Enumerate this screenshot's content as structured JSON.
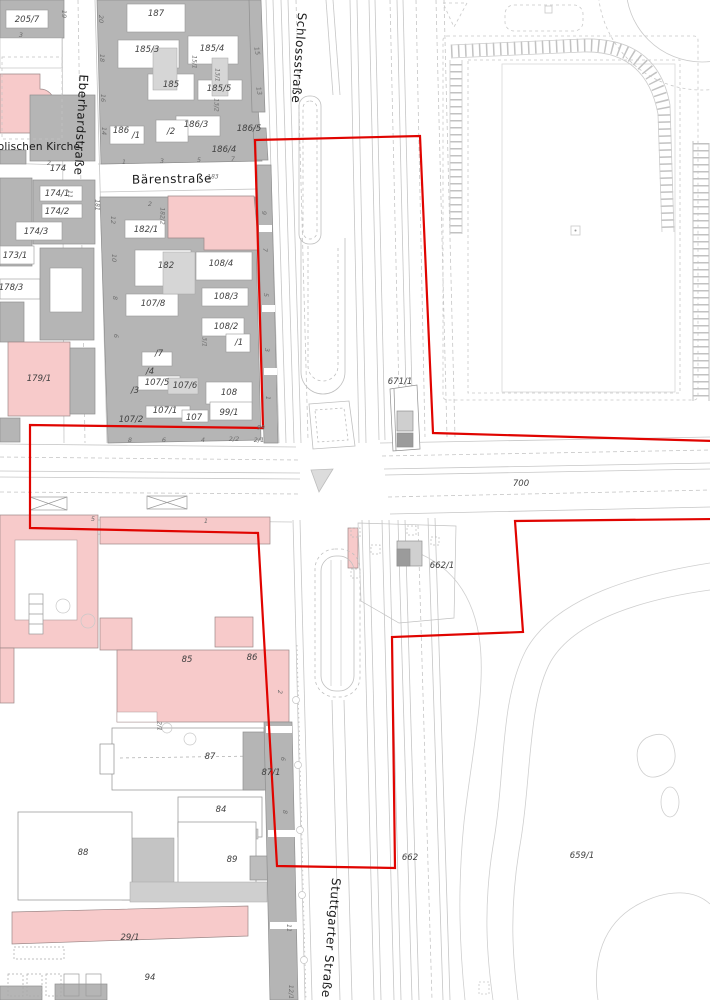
{
  "map": {
    "type": "cadastral-city-map",
    "colors": {
      "boundary_red": "#e00400",
      "building_gray": "#b5b5b5",
      "building_light": "#d6d6d6",
      "building_pink": "#f7caca",
      "road_line": "#c6c6c6"
    }
  },
  "map_labels": [
    {
      "name": "street-schlossstrasse",
      "text": "Schlossstraße",
      "x": 299,
      "y": 58,
      "rot": 94,
      "cls": "street"
    },
    {
      "name": "street-eberhardstrasse",
      "text": "Eberhardstraße",
      "x": 81,
      "y": 125,
      "rot": 93,
      "cls": "street"
    },
    {
      "name": "street-baerenstrasse",
      "text": "Bärenstraße",
      "x": 172,
      "y": 179,
      "rot": -1,
      "cls": "street"
    },
    {
      "name": "street-stuttgarter-strasse",
      "text": "Stuttgarter Straße",
      "x": 331,
      "y": 938,
      "rot": 95,
      "cls": "street"
    },
    {
      "name": "street-kirche-partial",
      "text": "olischen Kirche",
      "x": 39,
      "y": 147,
      "rot": 0,
      "cls": "street small"
    },
    {
      "name": "parcel-205-7",
      "text": "205/7",
      "x": 27,
      "y": 20,
      "cls": "parcel"
    },
    {
      "name": "parcel-187",
      "text": "187",
      "x": 156,
      "y": 14,
      "cls": "parcel"
    },
    {
      "name": "parcel-185-3",
      "text": "185/3",
      "x": 147,
      "y": 50,
      "cls": "parcel"
    },
    {
      "name": "parcel-185-4",
      "text": "185/4",
      "x": 212,
      "y": 49,
      "cls": "parcel"
    },
    {
      "name": "parcel-185",
      "text": "185",
      "x": 171,
      "y": 85,
      "cls": "parcel"
    },
    {
      "name": "parcel-185-5",
      "text": "185/5",
      "x": 219,
      "y": 89,
      "cls": "parcel"
    },
    {
      "name": "parcel-186-3",
      "text": "186/3",
      "x": 196,
      "y": 125,
      "cls": "parcel"
    },
    {
      "name": "parcel-186-5",
      "text": "186/5",
      "x": 249,
      "y": 129,
      "cls": "parcel"
    },
    {
      "name": "parcel-186-4",
      "text": "186/4",
      "x": 224,
      "y": 150,
      "cls": "parcel"
    },
    {
      "name": "parcel-186",
      "text": "186",
      "x": 121,
      "y": 131,
      "cls": "parcel"
    },
    {
      "name": "parcel-186-1",
      "text": "/1",
      "x": 136,
      "y": 136,
      "cls": "parcel"
    },
    {
      "name": "parcel-186-2",
      "text": "/2",
      "x": 171,
      "y": 132,
      "cls": "parcel"
    },
    {
      "name": "parcel-183",
      "text": "183",
      "x": 213,
      "y": 177,
      "cls": "tiny"
    },
    {
      "name": "parcel-181",
      "text": "181",
      "x": 97,
      "y": 205,
      "rot": 90,
      "cls": "tiny"
    },
    {
      "name": "parcel-15-1",
      "text": "15/1",
      "x": 194,
      "y": 62,
      "rot": 90,
      "cls": "tiny"
    },
    {
      "name": "parcel-13-1",
      "text": "13/1",
      "x": 217,
      "y": 75,
      "rot": 90,
      "cls": "tiny"
    },
    {
      "name": "parcel-13-2",
      "text": "13/2",
      "x": 216,
      "y": 105,
      "rot": 90,
      "cls": "tiny"
    },
    {
      "name": "parcel-174",
      "text": "174",
      "x": 58,
      "y": 169,
      "cls": "parcel"
    },
    {
      "name": "parcel-174-1",
      "text": "174/1",
      "x": 57,
      "y": 194,
      "cls": "parcel"
    },
    {
      "name": "parcel-174-2",
      "text": "174/2",
      "x": 57,
      "y": 212,
      "cls": "parcel"
    },
    {
      "name": "parcel-174-3",
      "text": "174/3",
      "x": 36,
      "y": 232,
      "cls": "parcel"
    },
    {
      "name": "parcel-173-1",
      "text": "173/1",
      "x": 15,
      "y": 256,
      "cls": "parcel"
    },
    {
      "name": "parcel-178-3",
      "text": "178/3",
      "x": 11,
      "y": 288,
      "cls": "parcel"
    },
    {
      "name": "parcel-179-1",
      "text": "179/1",
      "x": 39,
      "y": 379,
      "cls": "parcel"
    },
    {
      "name": "parcel-182-1",
      "text": "182/1",
      "x": 146,
      "y": 230,
      "cls": "parcel"
    },
    {
      "name": "parcel-182-2",
      "text": "182/2",
      "x": 162,
      "y": 216,
      "rot": 90,
      "cls": "tiny"
    },
    {
      "name": "parcel-182",
      "text": "182",
      "x": 166,
      "y": 266,
      "cls": "parcel"
    },
    {
      "name": "parcel-108-4",
      "text": "108/4",
      "x": 221,
      "y": 264,
      "cls": "parcel"
    },
    {
      "name": "parcel-108-3",
      "text": "108/3",
      "x": 226,
      "y": 297,
      "cls": "parcel"
    },
    {
      "name": "parcel-107-8",
      "text": "107/8",
      "x": 153,
      "y": 304,
      "cls": "parcel"
    },
    {
      "name": "parcel-108-2",
      "text": "108/2",
      "x": 226,
      "y": 327,
      "cls": "parcel"
    },
    {
      "name": "parcel-108-2-1",
      "text": "/1",
      "x": 239,
      "y": 343,
      "cls": "parcel"
    },
    {
      "name": "parcel-3-1",
      "text": "3/1",
      "x": 204,
      "y": 342,
      "rot": 90,
      "cls": "tiny"
    },
    {
      "name": "parcel-107-7",
      "text": "/7",
      "x": 159,
      "y": 354,
      "cls": "parcel"
    },
    {
      "name": "parcel-107-4",
      "text": "/4",
      "x": 150,
      "y": 372,
      "cls": "parcel"
    },
    {
      "name": "parcel-107-5",
      "text": "107/5",
      "x": 157,
      "y": 383,
      "cls": "parcel"
    },
    {
      "name": "parcel-107-6",
      "text": "107/6",
      "x": 185,
      "y": 386,
      "cls": "parcel"
    },
    {
      "name": "parcel-108",
      "text": "108",
      "x": 229,
      "y": 393,
      "cls": "parcel"
    },
    {
      "name": "parcel-107-3",
      "text": "/3",
      "x": 135,
      "y": 391,
      "cls": "parcel"
    },
    {
      "name": "parcel-107-2",
      "text": "107/2",
      "x": 131,
      "y": 420,
      "cls": "parcel"
    },
    {
      "name": "parcel-107-1",
      "text": "107/1",
      "x": 165,
      "y": 411,
      "cls": "parcel"
    },
    {
      "name": "parcel-107",
      "text": "107",
      "x": 194,
      "y": 418,
      "cls": "parcel"
    },
    {
      "name": "parcel-99-1",
      "text": "99/1",
      "x": 229,
      "y": 413,
      "cls": "parcel"
    },
    {
      "name": "parcel-99",
      "text": "99",
      "x": 261,
      "y": 428,
      "cls": "tiny"
    },
    {
      "name": "parcel-671-1",
      "text": "671/1",
      "x": 400,
      "y": 382,
      "cls": "parcel"
    },
    {
      "name": "parcel-700",
      "text": "700",
      "x": 521,
      "y": 484,
      "cls": "parcel"
    },
    {
      "name": "parcel-662-1",
      "text": "662/1",
      "x": 442,
      "y": 566,
      "cls": "parcel"
    },
    {
      "name": "parcel-662",
      "text": "662",
      "x": 410,
      "y": 858,
      "cls": "parcel"
    },
    {
      "name": "parcel-659-1",
      "text": "659/1",
      "x": 582,
      "y": 856,
      "cls": "parcel"
    },
    {
      "name": "parcel-85",
      "text": "85",
      "x": 187,
      "y": 660,
      "cls": "parcel"
    },
    {
      "name": "parcel-86",
      "text": "86",
      "x": 252,
      "y": 658,
      "cls": "parcel"
    },
    {
      "name": "parcel-87",
      "text": "87",
      "x": 210,
      "y": 757,
      "cls": "parcel"
    },
    {
      "name": "parcel-87-1",
      "text": "87/1",
      "x": 271,
      "y": 773,
      "cls": "parcel"
    },
    {
      "name": "parcel-84",
      "text": "84",
      "x": 221,
      "y": 810,
      "cls": "parcel"
    },
    {
      "name": "parcel-88",
      "text": "88",
      "x": 83,
      "y": 853,
      "cls": "parcel"
    },
    {
      "name": "parcel-89",
      "text": "89",
      "x": 232,
      "y": 860,
      "cls": "parcel"
    },
    {
      "name": "parcel-29-1",
      "text": "29/1",
      "x": 130,
      "y": 938,
      "cls": "parcel"
    },
    {
      "name": "parcel-94",
      "text": "94",
      "x": 150,
      "y": 978,
      "cls": "parcel"
    },
    {
      "name": "housenumber-20",
      "text": "20",
      "x": 101,
      "y": 19,
      "rot": 90,
      "cls": "hn"
    },
    {
      "name": "housenumber-18",
      "text": "18",
      "x": 102,
      "y": 58,
      "rot": 90,
      "cls": "hn"
    },
    {
      "name": "housenumber-16",
      "text": "16",
      "x": 103,
      "y": 98,
      "rot": 90,
      "cls": "hn"
    },
    {
      "name": "housenumber-14",
      "text": "14",
      "x": 104,
      "y": 131,
      "rot": 90,
      "cls": "hn"
    },
    {
      "name": "housenumber-19",
      "text": "19",
      "x": 64,
      "y": 14,
      "rot": 90,
      "cls": "hn"
    },
    {
      "name": "housenumber-3a",
      "text": "3",
      "x": 21,
      "y": 35,
      "cls": "hn"
    },
    {
      "name": "housenumber-15",
      "text": "15",
      "x": 257,
      "y": 51,
      "rot": 80,
      "cls": "hn"
    },
    {
      "name": "housenumber-13",
      "text": "13",
      "x": 259,
      "y": 91,
      "rot": 80,
      "cls": "hn"
    },
    {
      "name": "housenumber-1",
      "text": "1",
      "x": 124,
      "y": 162,
      "cls": "hn"
    },
    {
      "name": "housenumber-3",
      "text": "3",
      "x": 162,
      "y": 161,
      "cls": "hn"
    },
    {
      "name": "housenumber-5",
      "text": "5",
      "x": 199,
      "y": 160,
      "cls": "hn"
    },
    {
      "name": "housenumber-7",
      "text": "7",
      "x": 233,
      "y": 159,
      "cls": "hn"
    },
    {
      "name": "housenumber-2",
      "text": "2",
      "x": 150,
      "y": 204,
      "cls": "hn"
    },
    {
      "name": "housenumber-2c",
      "text": "2",
      "x": 49,
      "y": 163,
      "cls": "hn"
    },
    {
      "name": "housenumber-11w",
      "text": "11",
      "x": 70,
      "y": 194,
      "rot": 90,
      "cls": "hn"
    },
    {
      "name": "housenumber-12",
      "text": "12",
      "x": 113,
      "y": 220,
      "rot": 90,
      "cls": "hn"
    },
    {
      "name": "housenumber-10",
      "text": "10",
      "x": 114,
      "y": 258,
      "rot": 90,
      "cls": "hn"
    },
    {
      "name": "housenumber-8w",
      "text": "8",
      "x": 115,
      "y": 298,
      "rot": 90,
      "cls": "hn"
    },
    {
      "name": "housenumber-6w",
      "text": "6",
      "x": 116,
      "y": 336,
      "rot": 90,
      "cls": "hn"
    },
    {
      "name": "housenumber-9s",
      "text": "9",
      "x": 264,
      "y": 213,
      "rot": 90,
      "cls": "hn"
    },
    {
      "name": "housenumber-7s",
      "text": "7",
      "x": 265,
      "y": 250,
      "rot": 90,
      "cls": "hn"
    },
    {
      "name": "housenumber-5s",
      "text": "5",
      "x": 266,
      "y": 295,
      "rot": 90,
      "cls": "hn"
    },
    {
      "name": "housenumber-3s",
      "text": "3",
      "x": 267,
      "y": 350,
      "rot": 90,
      "cls": "hn"
    },
    {
      "name": "housenumber-1s",
      "text": "1",
      "x": 268,
      "y": 398,
      "rot": 90,
      "cls": "hn"
    },
    {
      "name": "housenumber-8b",
      "text": "8",
      "x": 130,
      "y": 440,
      "cls": "hn"
    },
    {
      "name": "housenumber-6b",
      "text": "6",
      "x": 164,
      "y": 440,
      "cls": "hn"
    },
    {
      "name": "housenumber-4b",
      "text": "4",
      "x": 203,
      "y": 440,
      "cls": "hn"
    },
    {
      "name": "housenumber-2-2",
      "text": "2/2",
      "x": 234,
      "y": 439,
      "cls": "hn"
    },
    {
      "name": "housenumber-2-1",
      "text": "2/1",
      "x": 259,
      "y": 440,
      "cls": "hn"
    },
    {
      "name": "housenumber-5c",
      "text": "5",
      "x": 93,
      "y": 519,
      "cls": "hn"
    },
    {
      "name": "housenumber-1c",
      "text": "1",
      "x": 206,
      "y": 521,
      "cls": "hn"
    },
    {
      "name": "housenumber-2-1v",
      "text": "2/1",
      "x": 159,
      "y": 726,
      "rot": 90,
      "cls": "tiny"
    },
    {
      "name": "housenumber-2s",
      "text": "2",
      "x": 280,
      "y": 692,
      "rot": 90,
      "cls": "hn"
    },
    {
      "name": "housenumber-6s",
      "text": "6",
      "x": 283,
      "y": 759,
      "rot": 90,
      "cls": "hn"
    },
    {
      "name": "housenumber-8s",
      "text": "8",
      "x": 285,
      "y": 812,
      "rot": 90,
      "cls": "hn"
    },
    {
      "name": "housenumber-11s",
      "text": "11",
      "x": 289,
      "y": 928,
      "rot": 90,
      "cls": "hn"
    },
    {
      "name": "housenumber-12-1s",
      "text": "12/1",
      "x": 291,
      "y": 992,
      "rot": 90,
      "cls": "hn"
    }
  ]
}
